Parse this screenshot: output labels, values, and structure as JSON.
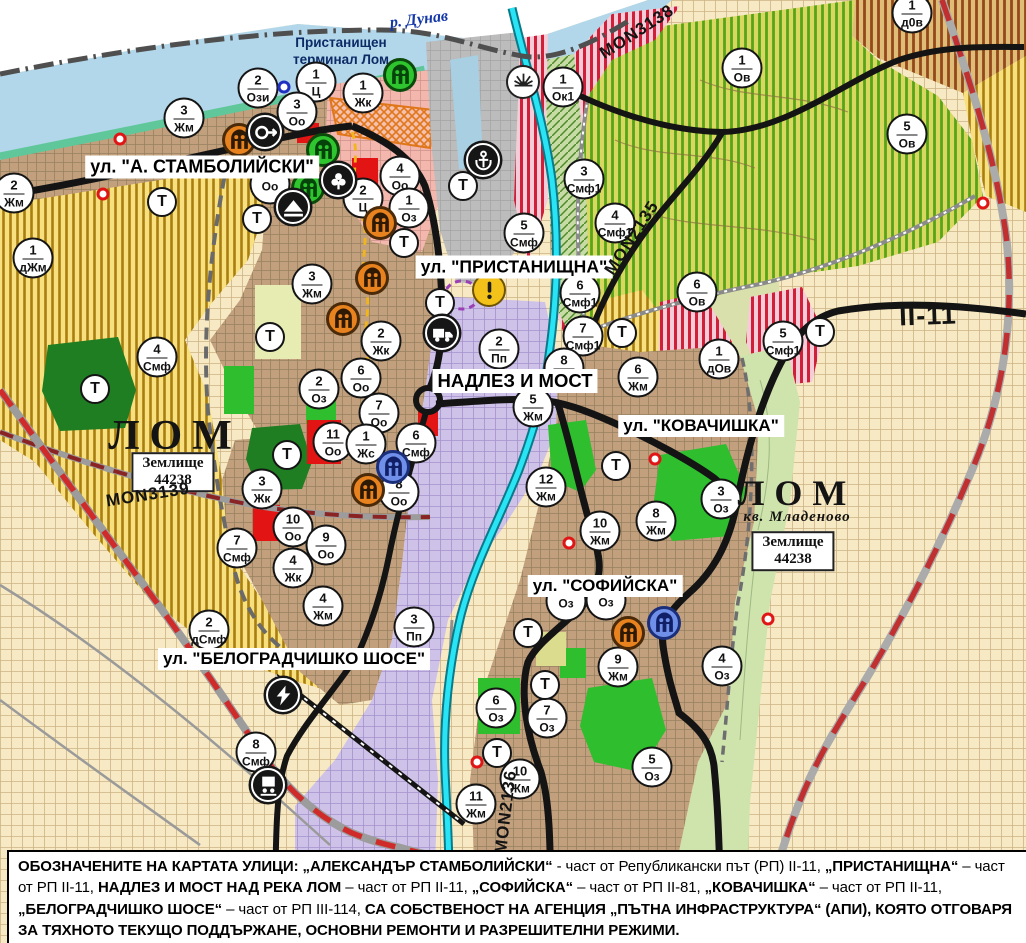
{
  "map": {
    "river_label": "р. Дунав",
    "port_label_line1": "Пристанищен",
    "port_label_line2": "терминал Лом",
    "street_labels": [
      {
        "text": "ул. \"А. СТАМБОЛИЙСКИ\"",
        "x": 202,
        "y": 167,
        "size": 18
      },
      {
        "text": "ул. \"ПРИСТАНИЩНА\"",
        "x": 514,
        "y": 267,
        "size": 17.5
      },
      {
        "text": "НАДЛЕЗ И МОСТ",
        "x": 515,
        "y": 381,
        "size": 18.5
      },
      {
        "text": "ул. \"КОВАЧИШКА\"",
        "x": 701,
        "y": 426,
        "size": 17
      },
      {
        "text": "ул. \"СОФИЙСКА\"",
        "x": 605,
        "y": 586,
        "size": 17
      },
      {
        "text": "ул. \"БЕЛОГРАДЧИШКО ШОСЕ\"",
        "x": 294,
        "y": 659,
        "size": 17
      }
    ],
    "city_labels": [
      {
        "text": "ЛОМ",
        "x": 175,
        "y": 437,
        "size": 42,
        "sub": ""
      },
      {
        "text": "ЛОМ",
        "x": 797,
        "y": 501,
        "size": 36,
        "sub": "кв. Младеново"
      }
    ],
    "plot_boxes": [
      {
        "line1": "Землище",
        "line2": "44238",
        "x": 173,
        "y": 472
      },
      {
        "line1": "Землище",
        "line2": "44238",
        "x": 793,
        "y": 551
      }
    ],
    "road_labels": [
      {
        "text": "MON3138",
        "x": 637,
        "y": 32,
        "rot": -33,
        "size": 17
      },
      {
        "text": "MON2135",
        "x": 632,
        "y": 238,
        "rot": -57,
        "size": 17
      },
      {
        "text": "MON3139",
        "x": 148,
        "y": 495,
        "rot": -9,
        "size": 17
      },
      {
        "text": "MON2136",
        "x": 506,
        "y": 812,
        "rot": -83,
        "size": 17
      },
      {
        "text": "II-11",
        "x": 928,
        "y": 316,
        "rot": -2,
        "size": 27
      }
    ],
    "zone_circles": [
      {
        "n": "2",
        "c": "Ози",
        "x": 258,
        "y": 88
      },
      {
        "n": "1",
        "c": "Ц",
        "x": 316,
        "y": 82
      },
      {
        "n": "3",
        "c": "Оо",
        "x": 297,
        "y": 112
      },
      {
        "n": "1",
        "c": "Жк",
        "x": 363,
        "y": 93
      },
      {
        "n": "",
        "c": "Оо",
        "x": 270,
        "y": 184
      },
      {
        "n": "4",
        "c": "Оо",
        "x": 400,
        "y": 176
      },
      {
        "n": "2",
        "c": "Ц",
        "x": 363,
        "y": 198
      },
      {
        "n": "1",
        "c": "Оз",
        "x": 409,
        "y": 208
      },
      {
        "n": "1",
        "c": "Ок1",
        "x": 563,
        "y": 87
      },
      {
        "n": "3",
        "c": "Жм",
        "x": 184,
        "y": 118
      },
      {
        "n": "2",
        "c": "Жм",
        "x": 14,
        "y": 193
      },
      {
        "n": "1",
        "c": "дЖм",
        "x": 33,
        "y": 258
      },
      {
        "n": "1",
        "c": "Ов",
        "x": 742,
        "y": 68
      },
      {
        "n": "5",
        "c": "Ов",
        "x": 907,
        "y": 134
      },
      {
        "n": "1",
        "c": "д0в",
        "x": 912,
        "y": 13
      },
      {
        "n": "3",
        "c": "Смф1",
        "x": 584,
        "y": 179
      },
      {
        "n": "4",
        "c": "Смф1",
        "x": 615,
        "y": 223
      },
      {
        "n": "5",
        "c": "Смф",
        "x": 524,
        "y": 233
      },
      {
        "n": "6",
        "c": "Ов",
        "x": 697,
        "y": 292
      },
      {
        "n": "5",
        "c": "Смф1",
        "x": 783,
        "y": 341
      },
      {
        "n": "1",
        "c": "дОв",
        "x": 719,
        "y": 359
      },
      {
        "n": "6",
        "c": "Смф1",
        "x": 580,
        "y": 293
      },
      {
        "n": "7",
        "c": "Смф1",
        "x": 583,
        "y": 336
      },
      {
        "n": "2",
        "c": "Пп",
        "x": 499,
        "y": 349
      },
      {
        "n": "8",
        "c": "Жм",
        "x": 564,
        "y": 368
      },
      {
        "n": "6",
        "c": "Жм",
        "x": 638,
        "y": 377
      },
      {
        "n": "5",
        "c": "Жм",
        "x": 533,
        "y": 407
      },
      {
        "n": "3",
        "c": "Жм",
        "x": 312,
        "y": 284
      },
      {
        "n": "2",
        "c": "Жк",
        "x": 381,
        "y": 341
      },
      {
        "n": "6",
        "c": "Оо",
        "x": 361,
        "y": 378
      },
      {
        "n": "2",
        "c": "Оз",
        "x": 319,
        "y": 389
      },
      {
        "n": "7",
        "c": "Оо",
        "x": 379,
        "y": 413
      },
      {
        "n": "11",
        "c": "Оо",
        "x": 333,
        "y": 442
      },
      {
        "n": "1",
        "c": "Жс",
        "x": 366,
        "y": 444
      },
      {
        "n": "6",
        "c": "Смф",
        "x": 416,
        "y": 443
      },
      {
        "n": "8",
        "c": "Оо",
        "x": 399,
        "y": 492
      },
      {
        "n": "3",
        "c": "Жк",
        "x": 262,
        "y": 489
      },
      {
        "n": "10",
        "c": "Оо",
        "x": 293,
        "y": 527
      },
      {
        "n": "9",
        "c": "Оо",
        "x": 326,
        "y": 545
      },
      {
        "n": "4",
        "c": "Жк",
        "x": 293,
        "y": 568
      },
      {
        "n": "7",
        "c": "Смф",
        "x": 237,
        "y": 548
      },
      {
        "n": "4",
        "c": "Смф",
        "x": 157,
        "y": 357
      },
      {
        "n": "4",
        "c": "Жм",
        "x": 323,
        "y": 606
      },
      {
        "n": "2",
        "c": "дСмф",
        "x": 209,
        "y": 630
      },
      {
        "n": "3",
        "c": "Пп",
        "x": 414,
        "y": 627
      },
      {
        "n": "8",
        "c": "Смф",
        "x": 256,
        "y": 752
      },
      {
        "n": "12",
        "c": "Жм",
        "x": 546,
        "y": 487
      },
      {
        "n": "10",
        "c": "Жм",
        "x": 600,
        "y": 531
      },
      {
        "n": "8",
        "c": "Жм",
        "x": 656,
        "y": 521
      },
      {
        "n": "3",
        "c": "Оз",
        "x": 721,
        "y": 499
      },
      {
        "n": "",
        "c": "Оз",
        "x": 566,
        "y": 601
      },
      {
        "n": "",
        "c": "Оз",
        "x": 606,
        "y": 600
      },
      {
        "n": "9",
        "c": "Жм",
        "x": 618,
        "y": 667
      },
      {
        "n": "4",
        "c": "Оз",
        "x": 722,
        "y": 666
      },
      {
        "n": "6",
        "c": "Оз",
        "x": 496,
        "y": 708
      },
      {
        "n": "7",
        "c": "Оз",
        "x": 547,
        "y": 718
      },
      {
        "n": "10",
        "c": "Жм",
        "x": 520,
        "y": 779
      },
      {
        "n": "11",
        "c": "Жм",
        "x": 476,
        "y": 804
      },
      {
        "n": "5",
        "c": "Оз",
        "x": 652,
        "y": 767
      }
    ],
    "t_circles": [
      {
        "x": 162,
        "y": 202
      },
      {
        "x": 257,
        "y": 219
      },
      {
        "x": 404,
        "y": 243
      },
      {
        "x": 463,
        "y": 186
      },
      {
        "x": 270,
        "y": 337
      },
      {
        "x": 95,
        "y": 389
      },
      {
        "x": 287,
        "y": 455
      },
      {
        "x": 440,
        "y": 303
      },
      {
        "x": 622,
        "y": 333
      },
      {
        "x": 820,
        "y": 332
      },
      {
        "x": 616,
        "y": 466
      },
      {
        "x": 528,
        "y": 633
      },
      {
        "x": 545,
        "y": 685
      },
      {
        "x": 497,
        "y": 753
      }
    ],
    "icon_markers": [
      {
        "type": "monument",
        "variant": "orange",
        "x": 239,
        "y": 140
      },
      {
        "type": "monument",
        "variant": "orange",
        "x": 380,
        "y": 223
      },
      {
        "type": "monument",
        "variant": "orange",
        "x": 372,
        "y": 278
      },
      {
        "type": "monument",
        "variant": "orange",
        "x": 343,
        "y": 319
      },
      {
        "type": "monument",
        "variant": "orange",
        "x": 368,
        "y": 490
      },
      {
        "type": "monument",
        "variant": "orange",
        "x": 628,
        "y": 633
      },
      {
        "type": "monument",
        "variant": "green",
        "x": 400,
        "y": 75
      },
      {
        "type": "monument",
        "variant": "green",
        "x": 323,
        "y": 150
      },
      {
        "type": "monument",
        "variant": "green",
        "x": 308,
        "y": 188
      },
      {
        "type": "monument",
        "variant": "blue",
        "x": 393,
        "y": 467
      },
      {
        "type": "monument",
        "variant": "blue",
        "x": 664,
        "y": 623
      },
      {
        "type": "arrow",
        "variant": "black",
        "x": 265,
        "y": 132
      },
      {
        "type": "trefoil",
        "variant": "black",
        "x": 338,
        "y": 180
      },
      {
        "type": "mound",
        "variant": "black",
        "x": 293,
        "y": 207
      },
      {
        "type": "anchor",
        "variant": "black",
        "x": 483,
        "y": 160
      },
      {
        "type": "truck",
        "variant": "black",
        "x": 442,
        "y": 333
      },
      {
        "type": "sun",
        "variant": "white",
        "x": 523,
        "y": 82
      },
      {
        "type": "warning",
        "variant": "yellow",
        "x": 489,
        "y": 290
      },
      {
        "type": "lightning",
        "variant": "black",
        "x": 283,
        "y": 695
      },
      {
        "type": "train",
        "variant": "black",
        "x": 268,
        "y": 785
      }
    ],
    "dots": [
      {
        "kind": "red",
        "x": 120,
        "y": 139
      },
      {
        "kind": "red",
        "x": 103,
        "y": 194
      },
      {
        "kind": "red",
        "x": 655,
        "y": 459
      },
      {
        "kind": "red",
        "x": 569,
        "y": 543
      },
      {
        "kind": "red",
        "x": 477,
        "y": 762
      },
      {
        "kind": "red",
        "x": 768,
        "y": 619
      },
      {
        "kind": "red",
        "x": 983,
        "y": 203
      },
      {
        "kind": "blue",
        "x": 284,
        "y": 87
      }
    ],
    "note_segments": [
      {
        "t": "ОБОЗНАЧЕНИТЕ НА КАРТАТА УЛИЦИ: „АЛЕКСАНДЪР СТАМБОЛИЙСКИ“",
        "b": 1
      },
      {
        "t": " - част от Републикански път (РП) II-11, ",
        "b": 0
      },
      {
        "t": "„ПРИСТАНИЩНА“",
        "b": 1
      },
      {
        "t": " – част от РП II-11, ",
        "b": 0
      },
      {
        "t": "НАДЛЕЗ И МОСТ НАД РЕКА ЛОМ",
        "b": 1
      },
      {
        "t": " – част от РП II-11, ",
        "b": 0
      },
      {
        "t": "„СОФИЙСКА“",
        "b": 1
      },
      {
        "t": " – част от РП II-81, ",
        "b": 0
      },
      {
        "t": "„КОВАЧИШКА“",
        "b": 1
      },
      {
        "t": " – част от РП II-11, ",
        "b": 0
      },
      {
        "t": "„БЕЛОГРАДЧИШКО ШОСЕ“",
        "b": 1
      },
      {
        "t": " – част от РП III-114, ",
        "b": 0
      },
      {
        "t": "СА СОБСТВЕНОСТ НА АГЕНЦИЯ „ПЪТНА ИНФРАСТРУКТУРА“ (АПИ), КОЯТО ОТГОВАРЯ ЗА ТЯХНОТО ТЕКУЩО ПОДДЪРЖАНЕ, ОСНОВНИ РЕМОНТИ И РАЗРЕШИТЕЛНИ РЕЖИМИ.",
        "b": 1
      }
    ],
    "palette": {
      "water": "#b3d7ea",
      "channel": "#29e4f4",
      "road": "#141414",
      "road_dash_red": "#cf2b2b",
      "urban": "#c2a07e",
      "industry_lavender": "#cfc2e8",
      "stripe_yellow": "#f8e07e",
      "stripe_green": "#d8d75f",
      "stripe_red": "#f5ccd7",
      "park_green": "#2ebe2e",
      "monument_orange": "#e8821e",
      "monument_blue": "#6f8fe8"
    }
  }
}
